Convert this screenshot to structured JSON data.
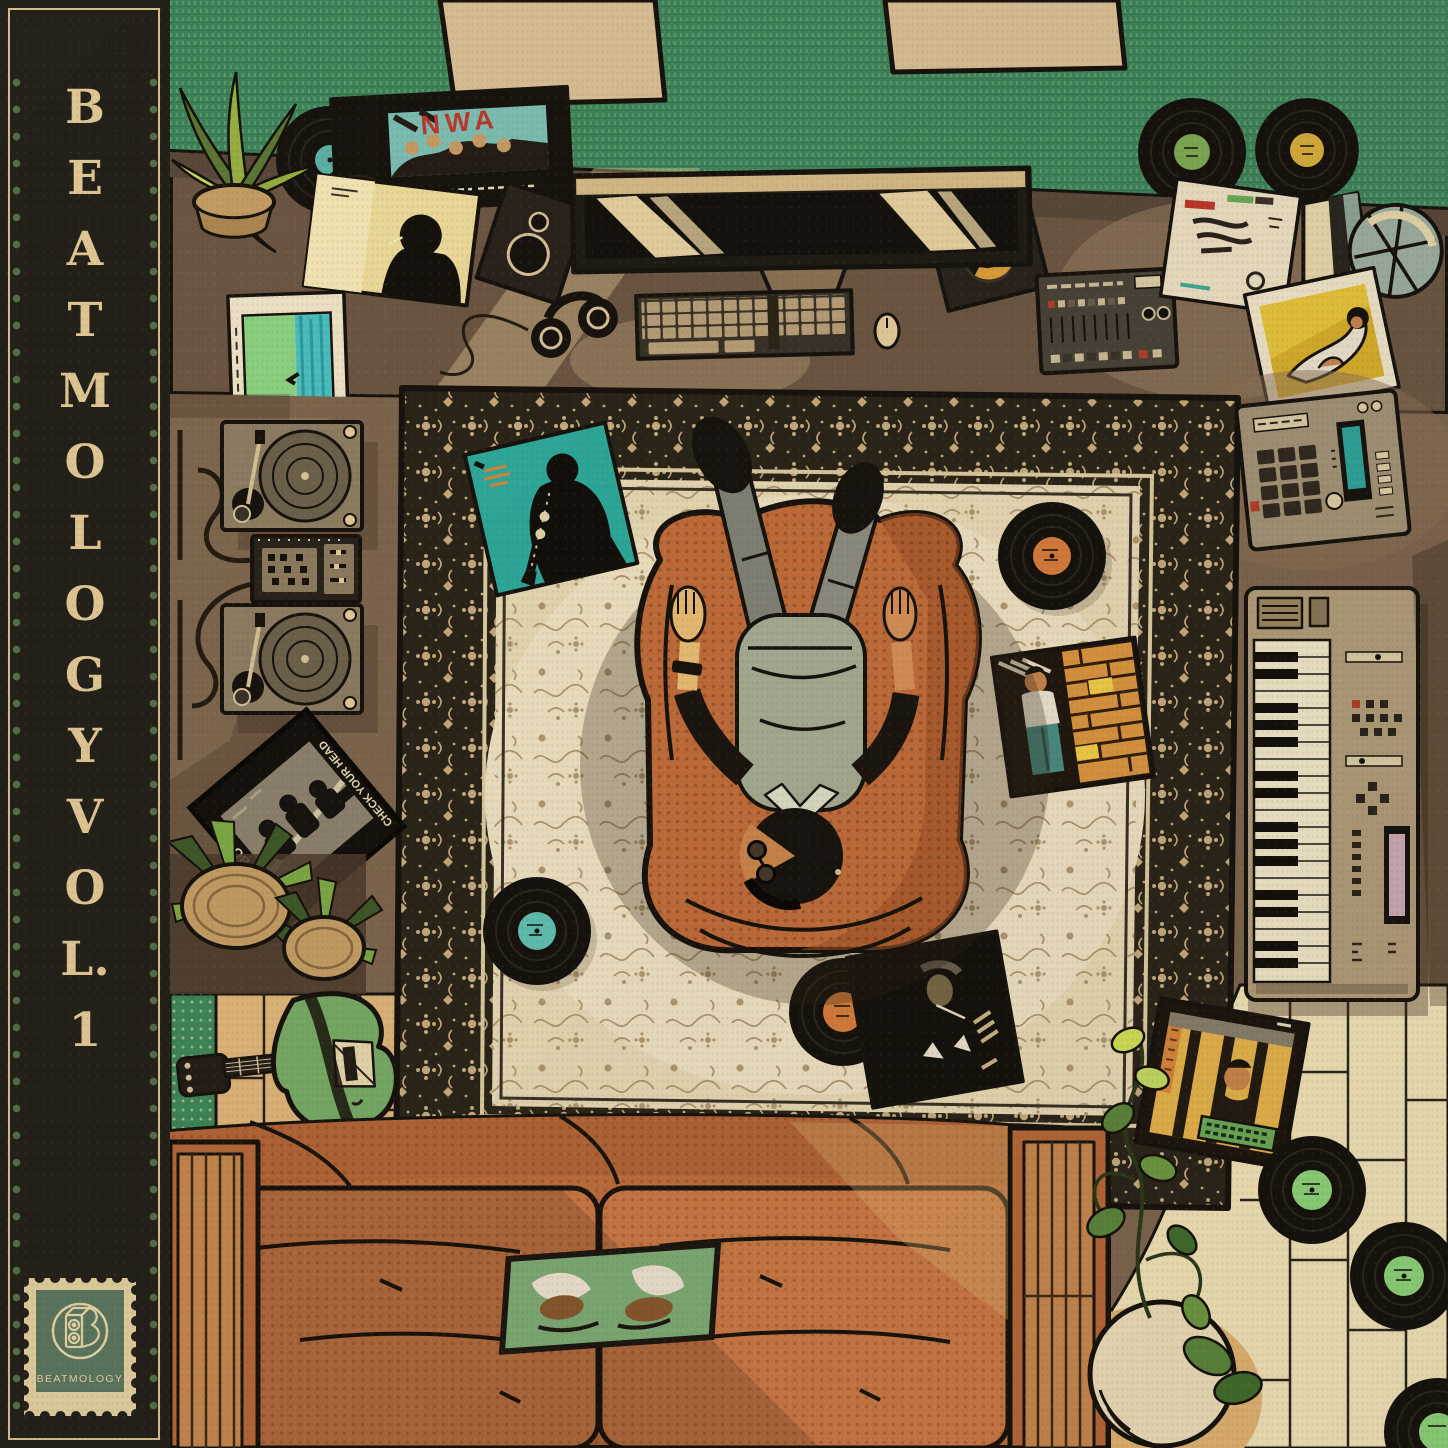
{
  "artwork": {
    "spine": {
      "title": "BEATMOLOGY VOL.1",
      "stamp_label": "BEATMOLOGY"
    },
    "album_text": {
      "nwa": "NWA",
      "beastie_left": "BEASTIE BOYS",
      "beastie_right": "CHECK YOUR HEAD"
    },
    "palette": {
      "paper": "#c9b18c",
      "spine_background": "#24211b",
      "spine_text": "#e4cf9d",
      "spine_dots": "#57714e",
      "stamp_green": "#5c7a63",
      "stamp_cream": "#e4d5a6",
      "wall_green": "#41885f",
      "panel_tan": "#dcc49c",
      "desk_brown": "#6d5947",
      "floor_brown": "#7f6852",
      "rug_border_dark": "#2b251a",
      "rug_field_cream": "#ebdfbd",
      "rug_motif_tan": "#a8916a",
      "chair_orange": "#c4703d",
      "couch_orange": "#c97a45",
      "accent_red": "#c0392e",
      "album_teal": "#2fb0a4",
      "guitar_green": "#79b06a",
      "vinyl_black": "#16120d",
      "label_green": "#8fd97f",
      "label_orange": "#d9813f",
      "label_teal": "#62c6bb",
      "label_yellow": "#d9b23e",
      "wood_floor_cream": "#f4e9bf",
      "wood_floor_tan": "#e2bb80",
      "skin_tone": "#d9945c",
      "shirt_sage": "#a9b19b",
      "pants_grey": "#83867c"
    }
  }
}
